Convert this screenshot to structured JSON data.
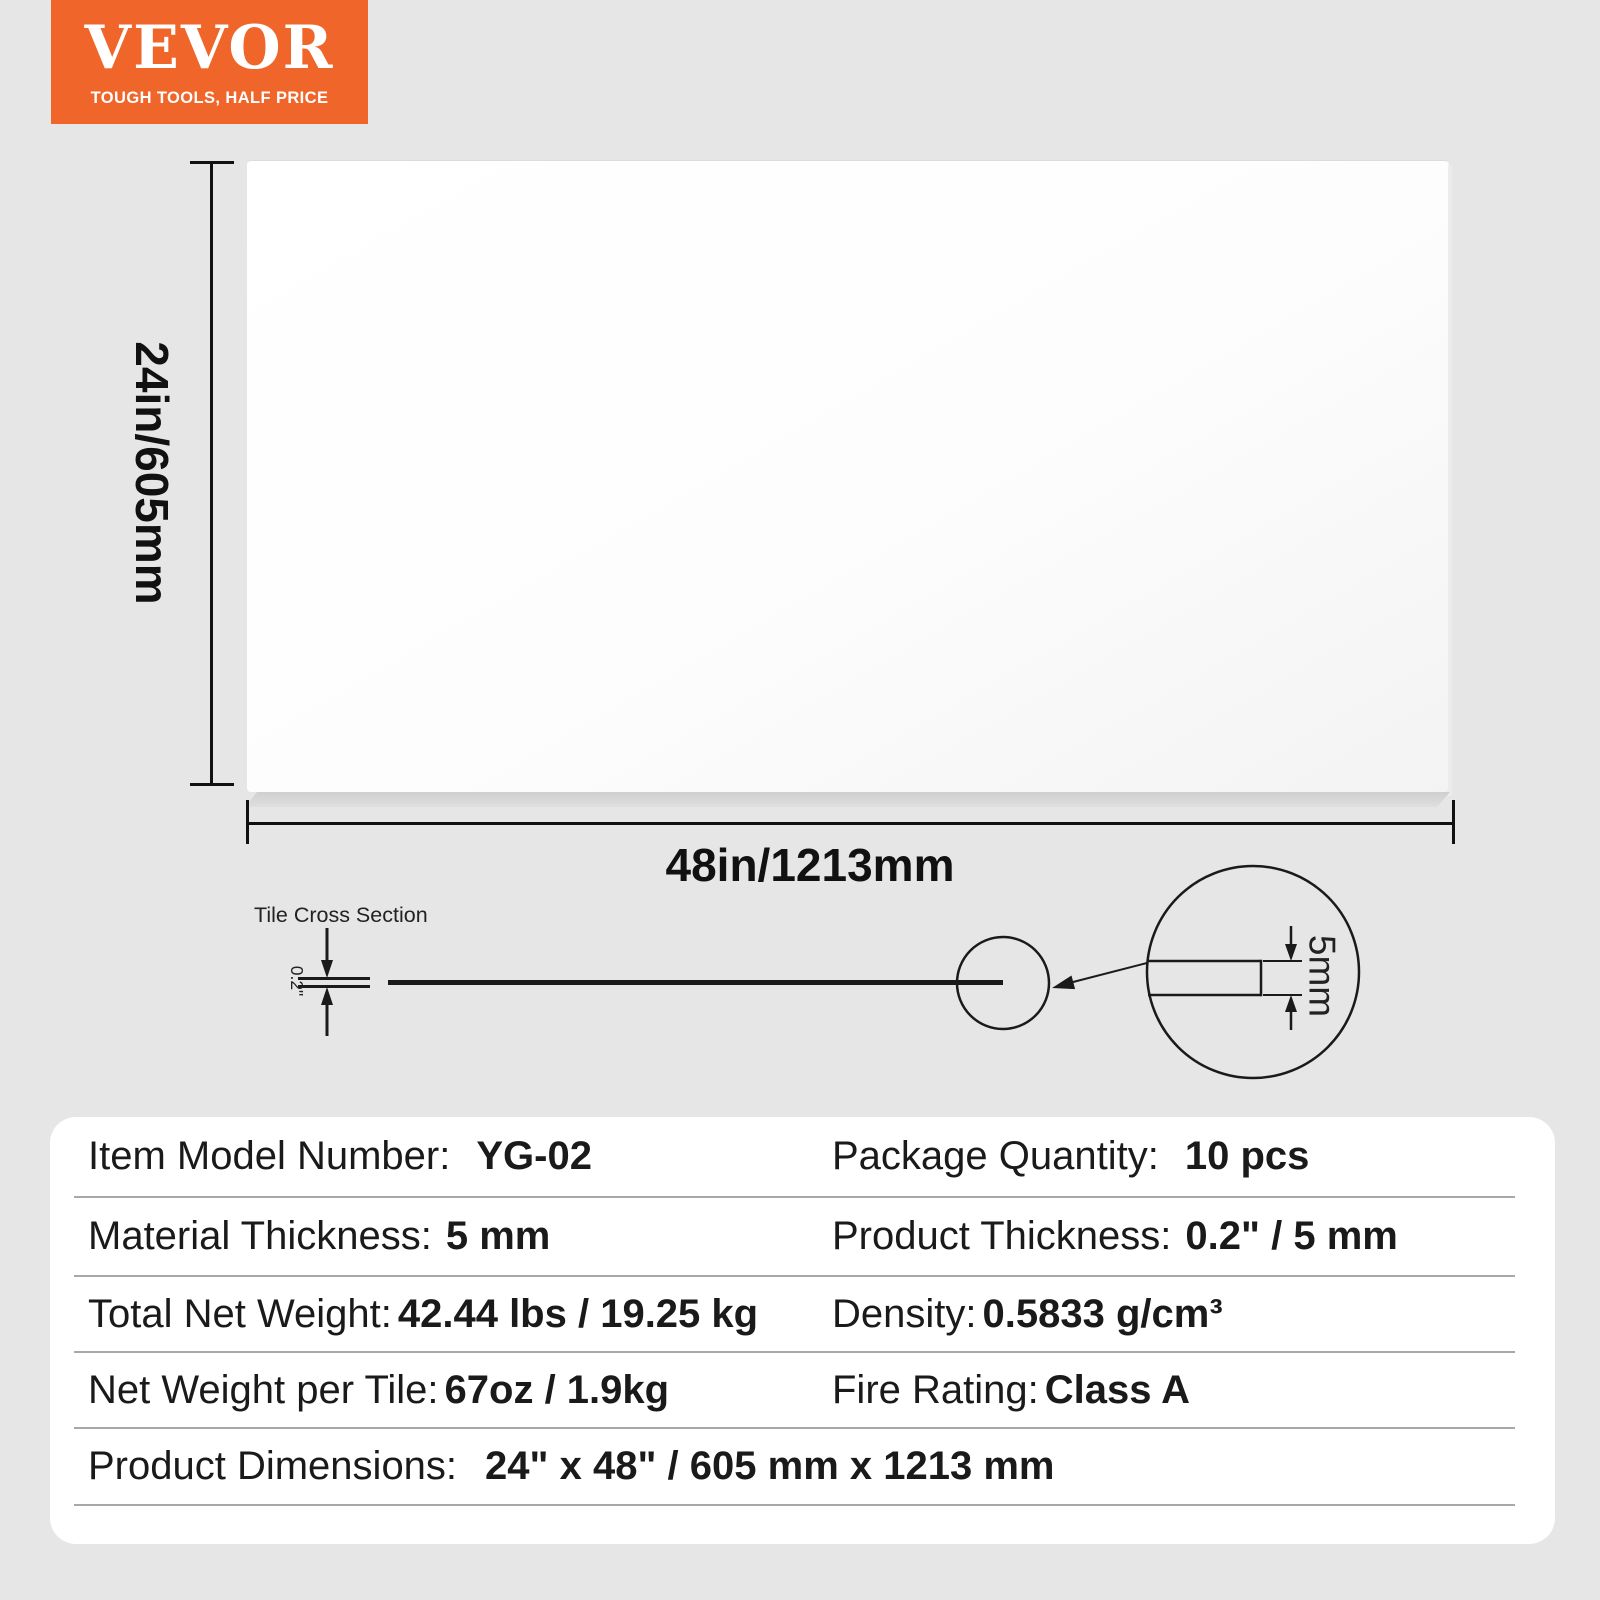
{
  "logo": {
    "brand": "VEVOR",
    "tagline": "TOUGH TOOLS, HALF PRICE"
  },
  "diagram": {
    "height_label": "24in/605mm",
    "width_label": "48in/1213mm",
    "cross_section": {
      "title": "Tile Cross Section",
      "thickness_inch_label": "0.2\"",
      "thickness_mm_label": "5mm"
    }
  },
  "specs": {
    "rows": [
      {
        "left_label": "Item Model Number:",
        "left_value": "YG-02",
        "right_label": "Package Quantity:",
        "right_value": "10 pcs"
      },
      {
        "left_label": "Material Thickness:",
        "left_value": "5 mm",
        "right_label": "Product Thickness:",
        "right_value": "0.2\" / 5 mm"
      },
      {
        "left_label": "Total Net Weight:",
        "left_value": "42.44 lbs / 19.25 kg",
        "right_label": "Density:",
        "right_value": "0.5833 g/cm³"
      },
      {
        "left_label": "Net Weight per Tile:",
        "left_value": "67oz / 1.9kg",
        "right_label": "Fire Rating:",
        "right_value": "Class A"
      },
      {
        "full_label": "Product Dimensions:",
        "full_value": "24\" x 48\" / 605 mm x 1213 mm"
      }
    ]
  },
  "colors": {
    "background": "#E6E6E6",
    "accent_orange": "#F0652A",
    "panel": "#FFFFFF",
    "line": "#111111"
  }
}
